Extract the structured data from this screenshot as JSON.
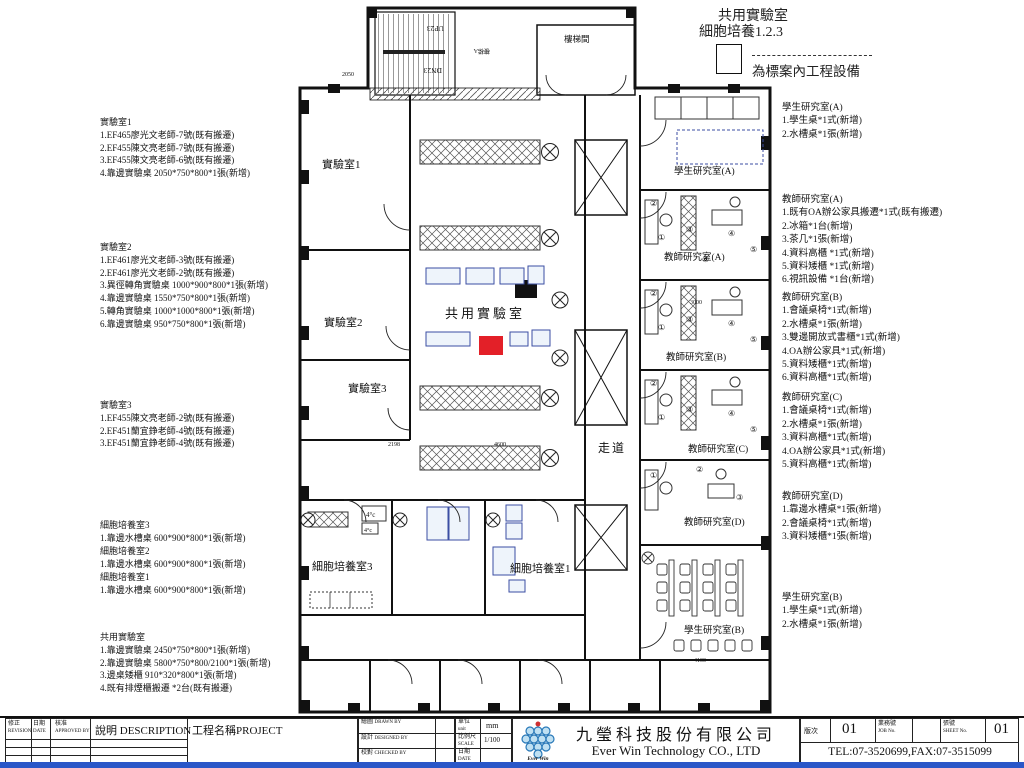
{
  "legend": {
    "title_line1": "共用實驗室",
    "title_line2": "細胞培養1.2.3",
    "note": "為標案內工程設備"
  },
  "notes_left": [
    {
      "title": "實驗室1",
      "lines": [
        "1.EF465廖光文老師-7號(既有搬遷)",
        "2.EF455陳文亮老師-7號(既有搬遷)",
        "3.EF455陳文亮老師-6號(既有搬遷)",
        "4.靠邊實驗桌 2050*750*800*1張(新增)"
      ]
    },
    {
      "title": "實驗室2",
      "lines": [
        "1.EF461廖光文老師-3號(既有搬遷)",
        "2.EF461廖光文老師-2號(既有搬遷)",
        "3.異徑轉角實驗桌 1000*900*800*1張(新增)",
        "4.靠邊實驗桌 1550*750*800*1張(新增)",
        "5.轉角實驗桌 1000*1000*800*1張(新增)",
        "6.靠邊實驗桌 950*750*800*1張(新增)"
      ]
    },
    {
      "title": "實驗室3",
      "lines": [
        "1.EF455陳文亮老師-2號(既有搬遷)",
        "2.EF451蘭宜錚老師-4號(既有搬遷)",
        "3.EF451蘭宜錚老師-4號(既有搬遷)"
      ]
    },
    {
      "title": "細胞培養室3",
      "lines": [
        "1.靠邊水槽桌 600*900*800*1張(新增)"
      ]
    },
    {
      "title": "細胞培養室2",
      "lines": [
        "1.靠邊水槽桌 600*900*800*1張(新增)"
      ]
    },
    {
      "title": "細胞培養室1",
      "lines": [
        "1.靠邊水槽桌 600*900*800*1張(新增)"
      ]
    },
    {
      "title": "共用實驗室",
      "lines": [
        "1.靠邊實驗桌 2450*750*800*1張(新增)",
        "2.靠邊實驗桌 5800*750*800/2100*1張(新增)",
        "3.邊桌矮櫃 910*320*800*1張(新增)",
        "4.既有排煙櫃搬遷 *2台(既有搬遷)"
      ]
    }
  ],
  "notes_right": [
    {
      "title": "學生研究室(A)",
      "lines": [
        "1.學生桌*1式(新增)",
        "2.水槽桌*1張(新增)"
      ]
    },
    {
      "title": "教師研究室(A)",
      "lines": [
        "1.既有OA辦公家具搬遷*1式(既有搬遷)",
        "2.冰箱*1台(新增)",
        "3.茶几*1張(新增)",
        "4.資料高櫃 *1式(新增)",
        "5.資料矮櫃 *1式(新增)",
        "6.視訊設備 *1台(新增)"
      ]
    },
    {
      "title": "教師研究室(B)",
      "lines": [
        "1.會議桌椅*1式(新增)",
        "2.水槽桌*1張(新增)",
        "3.雙邊開放式書櫃*1式(新增)",
        "4.OA辦公家具*1式(新增)",
        "5.資料矮櫃*1式(新增)",
        "6.資料高櫃*1式(新增)"
      ]
    },
    {
      "title": "教師研究室(C)",
      "lines": [
        "1.會議桌椅*1式(新增)",
        "2.水槽桌*1張(新增)",
        "3.資料高櫃*1式(新增)",
        "4.OA辦公家具*1式(新增)",
        "5.資料高櫃*1式(新增)"
      ]
    },
    {
      "title": "教師研究室(D)",
      "lines": [
        "1.靠邊水槽桌*1張(新增)",
        "2.會議桌椅*1式(新增)",
        "3.資料矮櫃*1張(新增)"
      ]
    },
    {
      "title": "學生研究室(B)",
      "lines": [
        "1.學生桌*1式(新增)",
        "2.水槽桌*1張(新增)"
      ]
    }
  ],
  "plan": {
    "rooms": {
      "lab1": "實驗室1",
      "lab2": "實驗室2",
      "lab3": "實驗室3",
      "shared": "共用實驗室",
      "corridor": "走道",
      "cell3": "細胞培養室3",
      "cell1": "細胞培養室1",
      "studentA": "學生研究室(A)",
      "teacherA": "教師研究室(A)",
      "teacherB": "教師研究室(B)",
      "teacherC": "教師研究室(C)",
      "teacherD": "教師研究室(D)",
      "studentB": "學生研究室(B)",
      "stairhall": "樓梯間",
      "stair": "樓梯A",
      "fridge": "4°c"
    },
    "stair_up": "UP23",
    "stair_down": "DN23",
    "dims": {
      "d1": "2050",
      "d2": "2198",
      "d3": "4600",
      "d4": "3000",
      "d5": "4100"
    },
    "circled": {
      "c1": "①",
      "c2": "②",
      "c3": "③",
      "c4": "④",
      "c5": "⑤",
      "c6": "⑥"
    },
    "highlight_color": "#e32028"
  },
  "title_block": {
    "revision_cn": "修正",
    "revision_en": "REVISION",
    "date_cn": "日期",
    "date_en": "DATE",
    "approved_cn": "核准",
    "approved_en": "APPROVED BY",
    "description": "說明 DESCRIPTION",
    "project": "工程名稱PROJECT",
    "drawn_cn": "繪圖",
    "drawn_en": "DRAWN BY",
    "designed_cn": "設計",
    "designed_en": "DESIGNED BY",
    "checked_cn": "校對",
    "checked_en": "CHECKED BY",
    "unit_cn": "單位",
    "unit_en": "unit",
    "unit_value": "mm",
    "scale_cn": "比例尺",
    "scale_en": "SCALE",
    "scale_value": "1/100",
    "date2_cn": "日期",
    "date2_en": "DATE",
    "version_label": "版次",
    "version_value": "01",
    "job_label": "業務號",
    "job_en": "JOB  No.",
    "sheet_label": "張號",
    "sheet_en": "SHEET No.",
    "sheet_value": "01",
    "company_cn": "九瑩科技股份有限公司",
    "company_en": "Ever Win Technology CO., LTD",
    "contact": "TEL:07-3520699,FAX:07-3515099",
    "logo_text": "Ever Win"
  }
}
